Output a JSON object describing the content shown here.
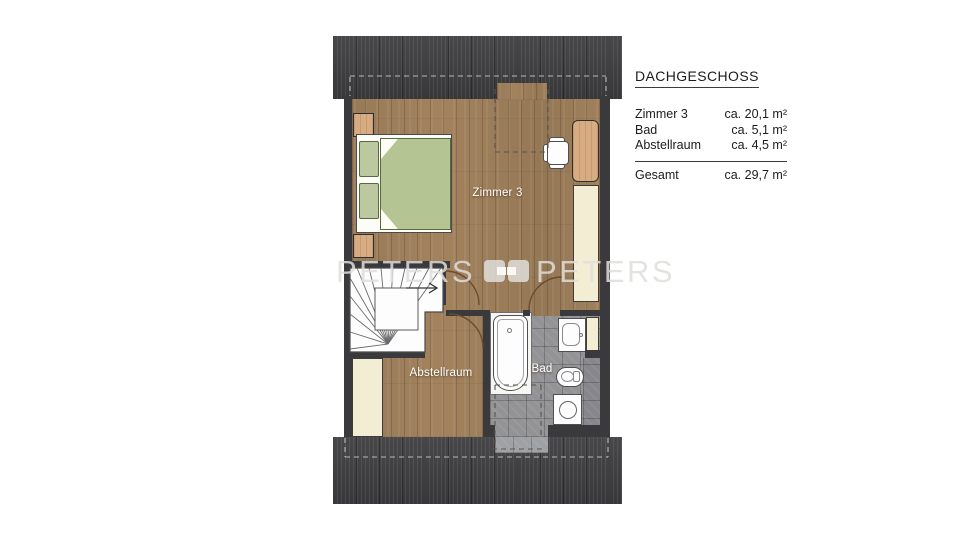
{
  "legend": {
    "title": "DACHGESCHOSS",
    "rows": [
      {
        "label": "Zimmer 3",
        "value": "ca. 20,1 m²"
      },
      {
        "label": "Bad",
        "value": "ca. 5,1 m²"
      },
      {
        "label": "Abstellraum",
        "value": "ca. 4,5 m²"
      }
    ],
    "total_label": "Gesamt",
    "total_value": "ca. 29,7 m²"
  },
  "rooms": {
    "zimmer3": "Zimmer 3",
    "abstellraum": "Abstellraum",
    "bad": "Bad"
  },
  "watermark": {
    "word_left": "PETERS",
    "word_right": "PETERS"
  },
  "icons": {
    "stair_direction": "arrow-right-icon",
    "logo_mark": "peters-brackets-icon"
  },
  "colors": {
    "roof": "#3e3e41",
    "wall": "#3a3a3d",
    "wood": "#a3835e",
    "tile": "#939396",
    "tile-light": "#9fa1a4",
    "tile-dark": "#86868b",
    "cream": "#f3eed3",
    "duvet": "#b4c493",
    "pillow": "#bcc9a0",
    "furniture-wood": "#d8ac83",
    "fixture": "#fdfdfd",
    "label": "#ffffff",
    "door": "#6b4c30",
    "dash-light": "#b9b9bd",
    "dash-dark": "#5b544c",
    "watermark": "rgba(223,222,219,0.85)"
  }
}
